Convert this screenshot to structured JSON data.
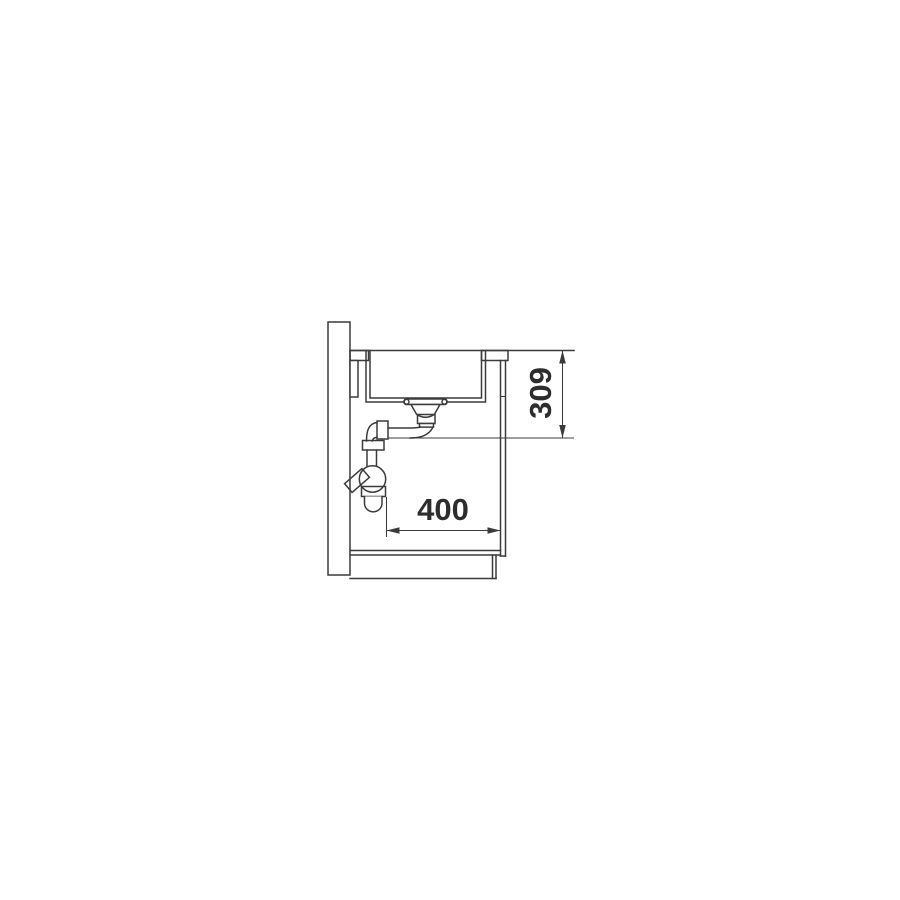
{
  "drawing": {
    "background": "#ffffff",
    "line_color": "#3b3b3b",
    "text_color": "#2d2d2d",
    "kind": "sink-installation-side-section",
    "dimensions": {
      "vertical": "309",
      "horizontal": "400"
    }
  }
}
